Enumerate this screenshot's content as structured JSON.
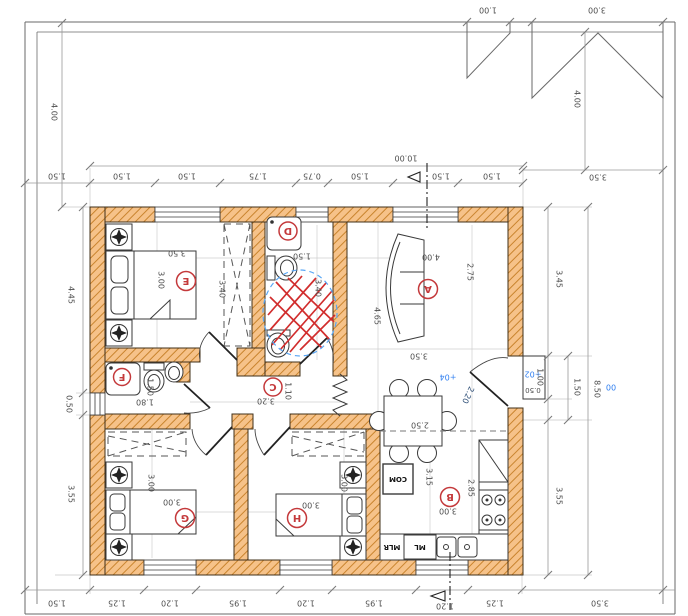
{
  "dims": {
    "top_total": "10.00",
    "top_chain": [
      "1.50",
      "1.50",
      "1.50",
      "1.75",
      "0.75",
      "1.50",
      "1.50",
      "1.50"
    ],
    "top_right_offset": "3.50",
    "canopy_small": "1.00",
    "canopy_large": "3.00",
    "left_setback": "4.00",
    "right_setback": "4.00",
    "left_chain": [
      "4.45",
      "0.50",
      "3.55"
    ],
    "right_chain": [
      "3.45",
      "1.00",
      "3.55"
    ],
    "right_entry": "1.50",
    "right_total": "8.50",
    "bottom_chain": [
      "1.50",
      "1.25",
      "1.20",
      "1.95",
      "1.20",
      "1.95",
      "1.20",
      "1.25"
    ],
    "bottom_right_offset": "3.50"
  },
  "levels": {
    "hall": "+04",
    "step": "+02",
    "site": "00",
    "step_depth": "0.50"
  },
  "rooms": {
    "A": {
      "letter": "A",
      "w": "4.00",
      "d1": "2.75",
      "d2": "4.65",
      "d3": "3.50"
    },
    "B": {
      "letter": "B",
      "w": "3.00",
      "d1": "3.15",
      "d2": "2.85"
    },
    "C": {
      "letter": "C",
      "w": "3.20",
      "d1": "1.10"
    },
    "D": {
      "letter": "D",
      "w": "1.50",
      "d1": "3.40"
    },
    "E": {
      "letter": "E",
      "w": "3.50",
      "d1": "3.00",
      "d2": "3.40"
    },
    "F": {
      "letter": "F",
      "w": "1.80",
      "d1": "1.50"
    },
    "G": {
      "letter": "G",
      "w": "3.00",
      "d1": "3.00"
    },
    "H": {
      "letter": "H",
      "w": "3.00",
      "d1": "3.00"
    }
  },
  "dining": {
    "width": "2.50"
  },
  "entry": {
    "door": "2.20"
  },
  "appliances": {
    "fridge": "COM",
    "dishwasher": "ML",
    "washer": "MLR"
  },
  "colors": {
    "wall_fill": "#f6c289",
    "wall_hatch": "#c9842e",
    "markup_red": "#d12d2d",
    "markup_blue": "#58a6f5",
    "level_blue": "#2e7ef0"
  }
}
